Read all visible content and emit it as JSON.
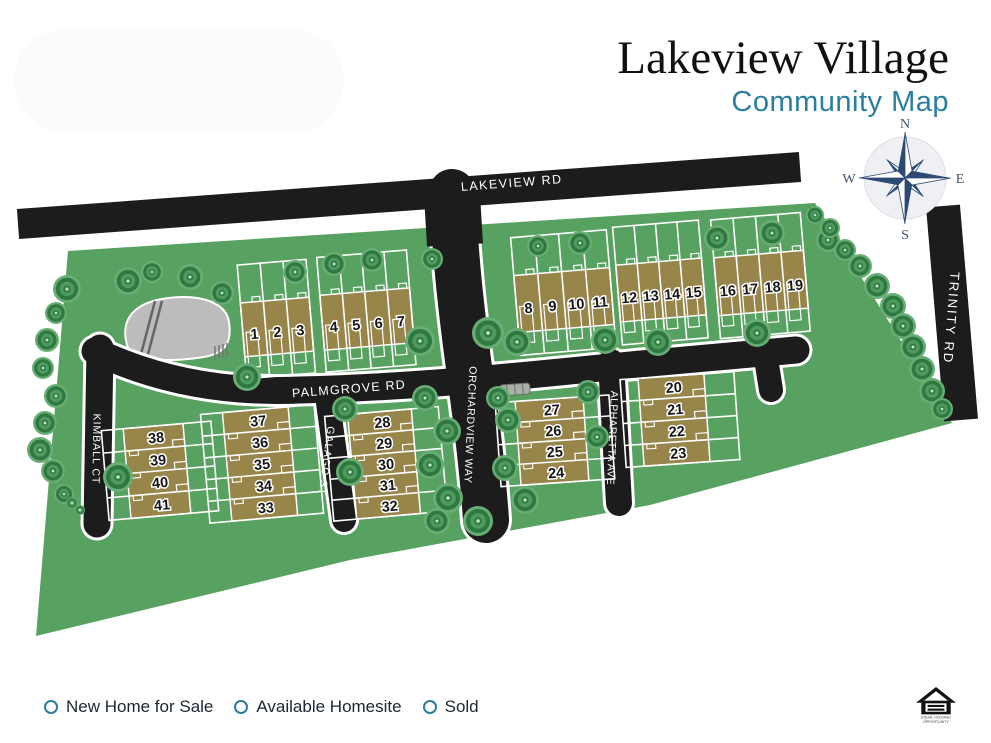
{
  "title": {
    "main": "Lakeview Village",
    "subtitle": "Community Map"
  },
  "compass": {
    "n": "N",
    "e": "E",
    "s": "S",
    "w": "W"
  },
  "roads": {
    "lakeview": {
      "label": "LAKEVIEW RD"
    },
    "palmgrove": {
      "label": "PALMGROVE RD"
    },
    "orchardview": {
      "label": "ORCHARDVIEW WAY"
    },
    "galago": {
      "label": "GALAGO ST"
    },
    "kimball": {
      "label": "KIMBALL CT"
    },
    "alpharetta": {
      "label": "ALPHARETTA AVE"
    },
    "trinity": {
      "label": "TRINITY RD"
    }
  },
  "legend": {
    "items": [
      {
        "label": "New Home for Sale"
      },
      {
        "label": "Available Homesite"
      },
      {
        "label": "Sold"
      }
    ]
  },
  "footer": {
    "equal_housing_line1": "EQUAL HOUSING",
    "equal_housing_line2": "OPPORTUNITY"
  },
  "map": {
    "colors": {
      "green": "#57a161",
      "building": "#97854a",
      "road": "#1c1c1c",
      "accent": "#2a7d9c",
      "compass": "#2c4a72",
      "pond": "#bcbcbc",
      "tree_dark": "#2f7841",
      "tree_mid": "#4f9a5e",
      "tree_light": "#68ad74",
      "tree_center": "#bfe3c4"
    },
    "blocks": [
      {
        "id": "lots-1-3",
        "orient": "v",
        "lots": [
          "1",
          "2",
          "3"
        ],
        "cx": 277,
        "cy": 327,
        "unitW": 23,
        "bH": 54,
        "rot": -4.8,
        "padTop": 38,
        "padBottom": 22
      },
      {
        "id": "lots-4-7",
        "orient": "v",
        "lots": [
          "4",
          "5",
          "6",
          "7"
        ],
        "cx": 367,
        "cy": 319,
        "unitW": 22.5,
        "bH": 55,
        "rot": -4.8,
        "padTop": 38,
        "padBottom": 22
      },
      {
        "id": "lots-8-11",
        "orient": "v",
        "lots": [
          "8",
          "9",
          "10",
          "11"
        ],
        "cx": 564,
        "cy": 300,
        "unitW": 24,
        "bH": 57,
        "rot": -4.8,
        "padTop": 38,
        "padBottom": 23
      },
      {
        "id": "lots-12-15",
        "orient": "v",
        "lots": [
          "12",
          "13",
          "14",
          "15"
        ],
        "cx": 661,
        "cy": 290,
        "unitW": 21.5,
        "bH": 57,
        "rot": -4.8,
        "padTop": 38,
        "padBottom": 23
      },
      {
        "id": "lots-16-19",
        "orient": "v",
        "lots": [
          "16",
          "17",
          "18",
          "19"
        ],
        "cx": 761,
        "cy": 283,
        "unitW": 22.5,
        "bH": 58,
        "rot": -4.8,
        "padTop": 38,
        "padBottom": 23
      },
      {
        "id": "lots-38-41",
        "orient": "h",
        "lots": [
          "38",
          "39",
          "40",
          "41"
        ],
        "cx": 157,
        "cy": 471,
        "bW": 60,
        "rowH": 22.5,
        "rot": -5,
        "padL": 22,
        "padR": 28
      },
      {
        "id": "lots-37-33",
        "orient": "h",
        "lots": [
          "37",
          "36",
          "35",
          "34",
          "33"
        ],
        "cx": 260,
        "cy": 464,
        "bW": 66,
        "rowH": 21.8,
        "rot": -5,
        "padL": 22,
        "padR": 26
      },
      {
        "id": "lots-28-32",
        "orient": "h",
        "lots": [
          "28",
          "29",
          "30",
          "31",
          "32"
        ],
        "cx": 384,
        "cy": 464,
        "bW": 64,
        "rowH": 21,
        "rot": -5,
        "padL": 23,
        "padR": 27
      },
      {
        "id": "lots-27-24",
        "orient": "h",
        "lots": [
          "27",
          "26",
          "25",
          "24"
        ],
        "cx": 552,
        "cy": 441,
        "bW": 68,
        "rowH": 21,
        "rot": -4,
        "padL": 20,
        "padR": 26
      },
      {
        "id": "lots-20-23",
        "orient": "h",
        "lots": [
          "20",
          "21",
          "22",
          "23"
        ],
        "cx": 674,
        "cy": 420,
        "bW": 66,
        "rowH": 22,
        "rot": -4,
        "padL": 18,
        "padR": 30
      }
    ],
    "trees": [
      [
        67,
        289,
        14
      ],
      [
        56,
        313,
        11
      ],
      [
        47,
        340,
        12
      ],
      [
        43,
        368,
        11
      ],
      [
        56,
        396,
        12
      ],
      [
        45,
        423,
        12
      ],
      [
        40,
        450,
        13
      ],
      [
        53,
        471,
        12
      ],
      [
        64,
        494,
        10
      ],
      [
        72,
        503,
        6
      ],
      [
        80,
        510,
        5
      ],
      [
        118,
        477,
        15
      ],
      [
        128,
        281,
        14
      ],
      [
        152,
        272,
        11
      ],
      [
        190,
        277,
        13
      ],
      [
        222,
        293,
        12
      ],
      [
        247,
        377,
        14
      ],
      [
        295,
        272,
        12
      ],
      [
        334,
        264,
        12
      ],
      [
        372,
        260,
        12
      ],
      [
        420,
        341,
        15
      ],
      [
        432,
        259,
        11
      ],
      [
        345,
        409,
        13
      ],
      [
        350,
        472,
        14
      ],
      [
        488,
        333,
        16
      ],
      [
        517,
        342,
        14
      ],
      [
        498,
        398,
        12
      ],
      [
        508,
        420,
        13
      ],
      [
        505,
        468,
        13
      ],
      [
        525,
        500,
        14
      ],
      [
        478,
        521,
        15
      ],
      [
        448,
        498,
        15
      ],
      [
        430,
        465,
        14
      ],
      [
        447,
        431,
        14
      ],
      [
        425,
        398,
        13
      ],
      [
        437,
        521,
        13
      ],
      [
        538,
        246,
        11
      ],
      [
        580,
        243,
        12
      ],
      [
        605,
        340,
        14
      ],
      [
        658,
        342,
        14
      ],
      [
        757,
        333,
        14
      ],
      [
        717,
        238,
        13
      ],
      [
        772,
        233,
        13
      ],
      [
        828,
        240,
        12
      ],
      [
        588,
        392,
        12
      ],
      [
        597,
        437,
        12
      ],
      [
        815,
        215,
        9
      ],
      [
        830,
        228,
        10
      ],
      [
        845,
        250,
        11
      ],
      [
        860,
        266,
        12
      ],
      [
        877,
        286,
        13
      ],
      [
        893,
        306,
        13
      ],
      [
        903,
        326,
        13
      ],
      [
        913,
        347,
        13
      ],
      [
        922,
        369,
        13
      ],
      [
        932,
        391,
        13
      ],
      [
        942,
        409,
        11
      ]
    ]
  }
}
